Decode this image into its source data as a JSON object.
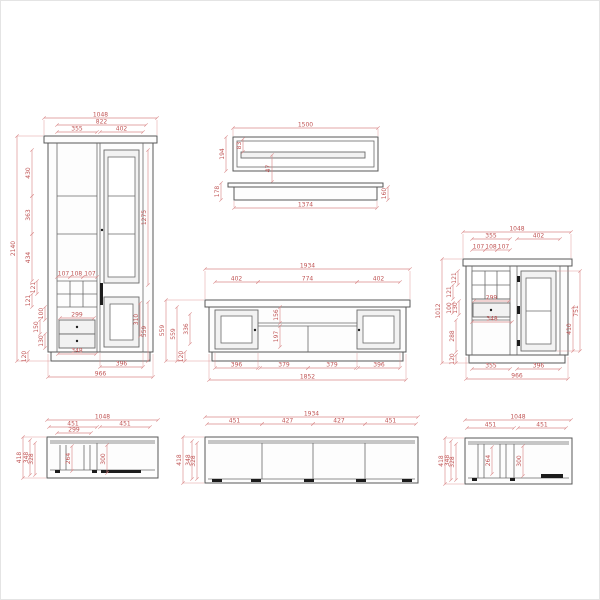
{
  "diagram": {
    "type": "furniture-technical-drawing",
    "colors": {
      "dimension_text": "#c05555",
      "dimension_line": "#da8a8a",
      "furniture_line": "#585858",
      "background": "#ffffff"
    },
    "views": {
      "wardrobe_front": {
        "title": "display-cabinet-front-view",
        "dims": {
          "total_w": "1048",
          "inner_w": "822",
          "sec_left": "355",
          "sec_right": "402",
          "total_h": "2140",
          "row1": "430",
          "row2": "363",
          "row3": "434",
          "door_h": "1275",
          "pane1": "107",
          "pane2": "108",
          "pane3": "107",
          "row4": "121",
          "row5": "121",
          "drw_a": "100",
          "drw_b": "150",
          "drw_c": "130",
          "drawer_w": "299",
          "drawer_out": "348",
          "panel_h": "310",
          "lower_h": "559",
          "plinth_h": "120",
          "door_w": "396",
          "base_w": "966"
        }
      },
      "shelf": {
        "title": "wall-shelf-views",
        "dims": {
          "top_w": "1500",
          "depth": "194",
          "edge": "83",
          "slot_off": "47",
          "front_w": "1374",
          "h_left": "178",
          "h_right": "160"
        }
      },
      "sideboard_front": {
        "title": "sideboard-front-view",
        "dims": {
          "total_w": "1934",
          "sec_l": "402",
          "sec_m": "774",
          "sec_r": "402",
          "h_total": "559",
          "h_body": "559",
          "panel_h": "336",
          "plinth_h": "120",
          "open_top": "156",
          "open_bottom": "197",
          "b1": "396",
          "b2": "379",
          "b3": "379",
          "b4": "396",
          "base_w": "1852"
        }
      },
      "highboard_front": {
        "title": "highboard-front-view",
        "dims": {
          "total_w": "1048",
          "sec_l": "355",
          "sec_r": "402",
          "pane1": "107",
          "pane2": "108",
          "pane3": "107",
          "total_h": "1012",
          "row1": "121",
          "row2": "121",
          "drw_a": "130",
          "drw_b": "100",
          "open_h": "288",
          "plinth_h": "120",
          "drawer_w": "299",
          "drawer_out": "348",
          "door_h": "751",
          "panel_h": "410",
          "b1": "355",
          "b2": "396",
          "base_w": "966"
        }
      },
      "cabinet_top_left": {
        "title": "display-cabinet-top-view",
        "dims": {
          "total_w": "1048",
          "w1": "451",
          "w2": "451",
          "inner_w": "299",
          "depth": "418",
          "d1": "348",
          "d2": "328",
          "i1": "264",
          "i2": "300"
        }
      },
      "sideboard_top": {
        "title": "sideboard-top-view",
        "dims": {
          "total_w": "1934",
          "w1": "451",
          "w2": "427",
          "w3": "427",
          "w4": "451",
          "depth": "418",
          "d1": "348",
          "d2": "328"
        }
      },
      "cabinet_top_right": {
        "title": "highboard-top-view",
        "dims": {
          "total_w": "1048",
          "w1": "451",
          "w2": "451",
          "depth": "418",
          "d1": "348",
          "d2": "328",
          "i1": "264",
          "i2": "300"
        }
      }
    }
  }
}
